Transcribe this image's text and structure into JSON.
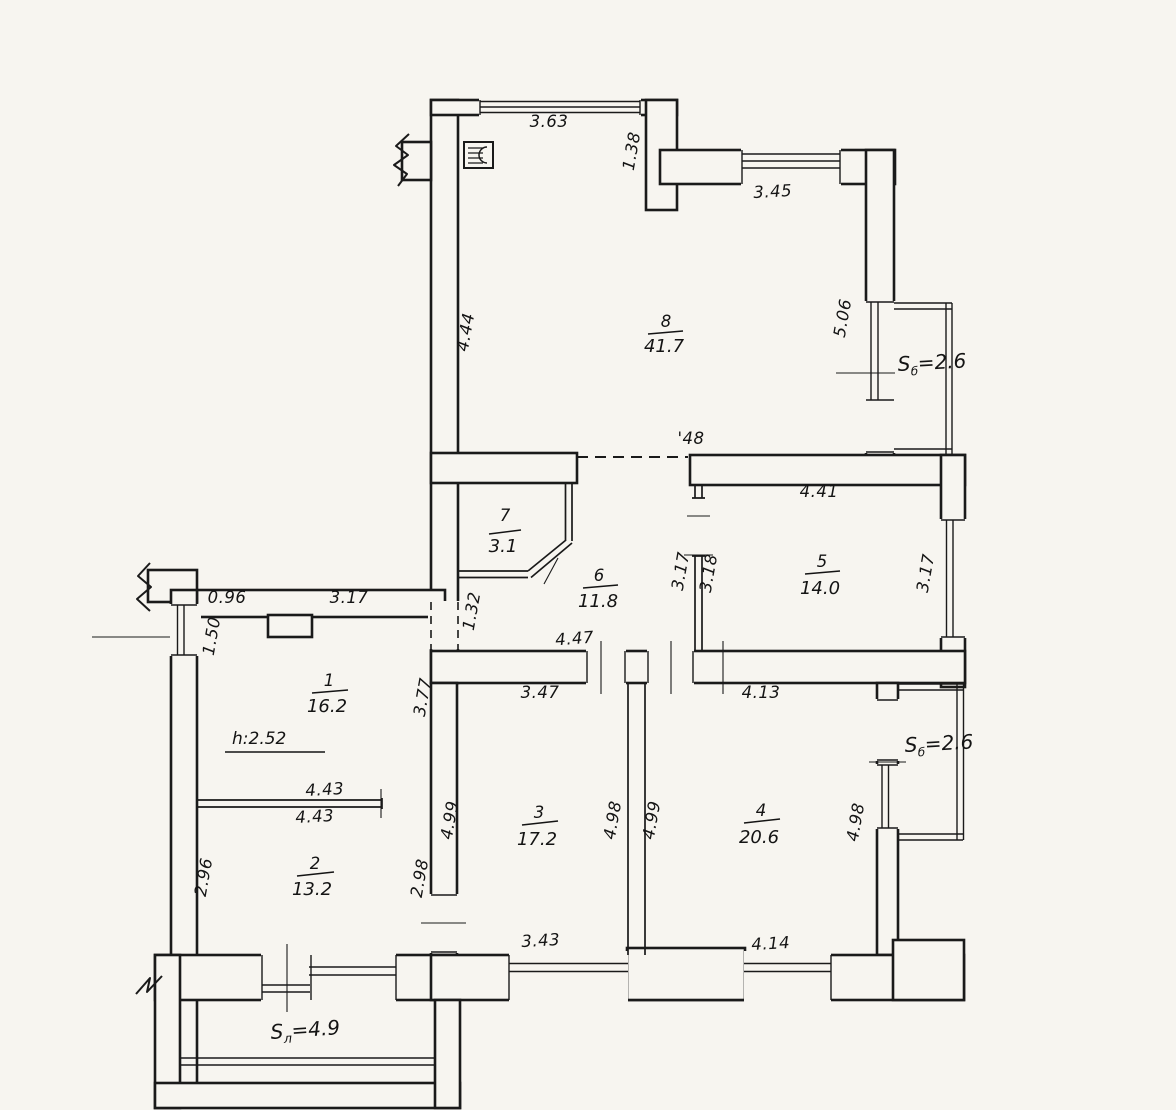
{
  "plan": {
    "rooms": [
      {
        "number": "1",
        "area": "16.2"
      },
      {
        "number": "2",
        "area": "13.2"
      },
      {
        "number": "3",
        "area": "17.2"
      },
      {
        "number": "4",
        "area": "20.6"
      },
      {
        "number": "5",
        "area": "14.0"
      },
      {
        "number": "6",
        "area": "11.8"
      },
      {
        "number": "7",
        "area": "3.1"
      },
      {
        "number": "8",
        "area": "41.7"
      }
    ],
    "balconies": [
      {
        "sym": "S",
        "sub": "б",
        "val": "=2.6",
        "loc": "top-right"
      },
      {
        "sym": "S",
        "sub": "б",
        "val": "=2.6",
        "loc": "right"
      },
      {
        "sym": "S",
        "sub": "л",
        "val": "=4.9",
        "loc": "bottom-left"
      }
    ],
    "notes": {
      "ceiling_height": "h:2.52",
      "opening": "'48"
    },
    "dims": {
      "top_window": "3.63",
      "top_right_inset": "1.38",
      "top_right_window": "3.45",
      "room8_left": "4.44",
      "room8_right": "5.06",
      "room5_top": "4.41",
      "room5_left": "3.18",
      "room5_right": "3.17",
      "room6_right": "3.17",
      "room6_bottom": "4.47",
      "hall_passage": "1.32",
      "room1_top_a": "0.96",
      "room1_top_b": "3.17",
      "room1_left": "1.50",
      "room1_right": "3.77",
      "part12_top": "4.43",
      "part12_bottom": "4.43",
      "room2_left": "2.96",
      "room2_right": "2.98",
      "room3_top": "3.47",
      "room3_left": "4.99",
      "room3_right": "4.98",
      "room3_bottom": "3.43",
      "room4_top": "4.13",
      "room4_left": "4.99",
      "room4_right": "4.98",
      "room4_bottom": "4.14"
    }
  }
}
